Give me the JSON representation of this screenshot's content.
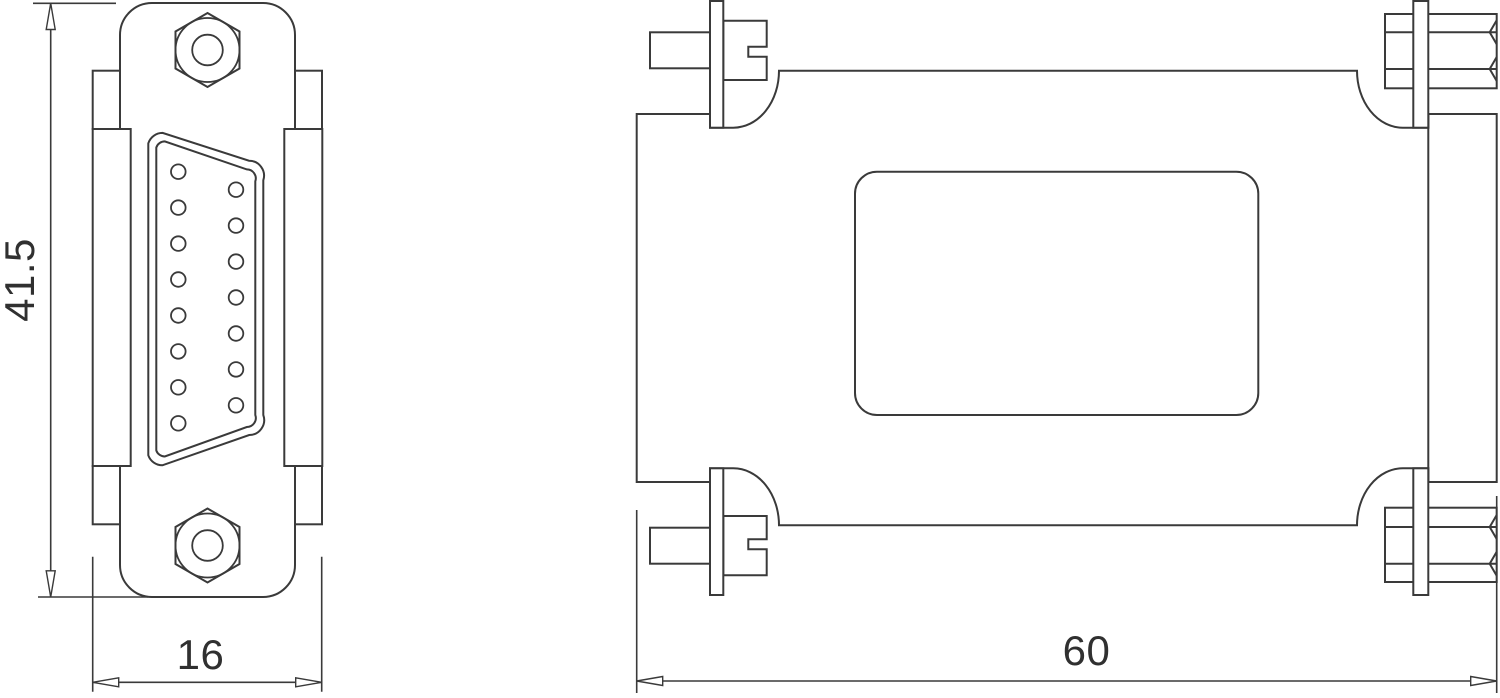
{
  "page": {
    "background_color": "#ffffff"
  },
  "drawing": {
    "line_color": "#3a3a3a",
    "text_color": "#303030",
    "views": {
      "front_view": {
        "pins_left_column": 8,
        "pins_right_column": 7,
        "pins_total": 15,
        "hex_jack_nuts": 2,
        "side_flanges": 2
      },
      "side_view": {
        "slotted_screws_left": 2,
        "hex_screwlocks_right": 2,
        "bracket_plates": 4,
        "label_recess": 1
      }
    },
    "dimensions": {
      "front_height": {
        "value": "41.5"
      },
      "front_width": {
        "value": "16"
      },
      "side_length": {
        "value": "60"
      }
    }
  }
}
